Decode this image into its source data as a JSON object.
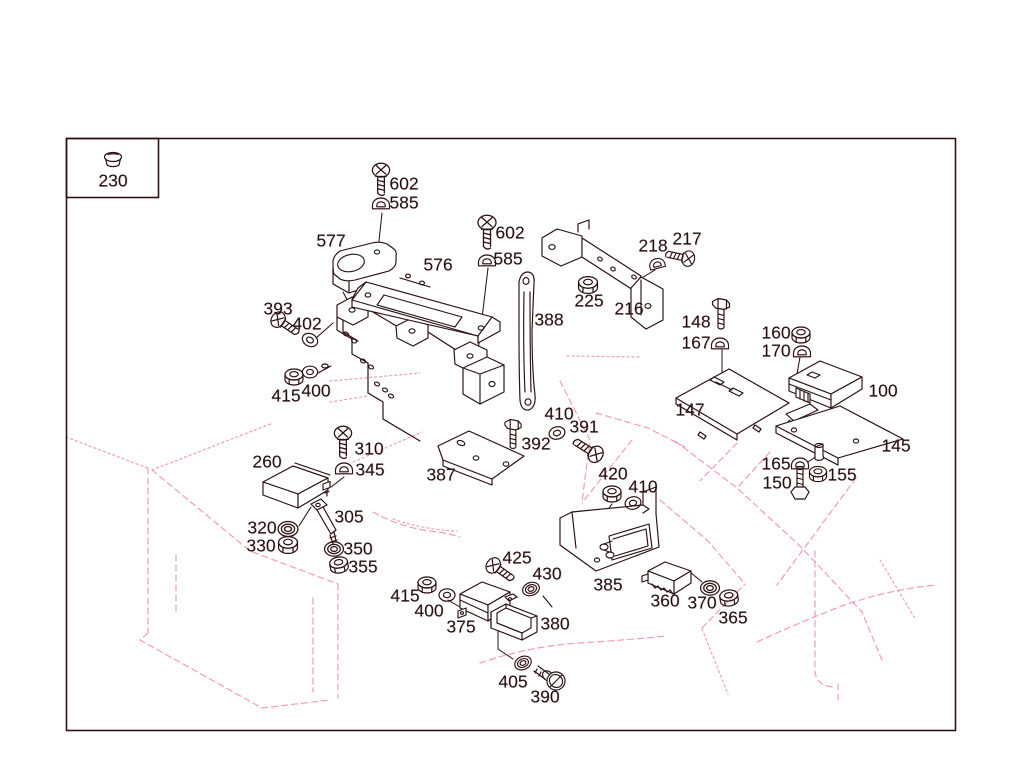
{
  "document": {
    "type": "exploded-parts-diagram",
    "legend_box": {
      "part": "230",
      "icon": "cap-fastener"
    }
  },
  "diagram": {
    "colors": {
      "ink": "#2a1213",
      "body": "#f09fb0",
      "text": "#1b1111",
      "paper": "#ffffff"
    },
    "labels": [
      {
        "part": "230",
        "x": 113,
        "y": 181
      },
      {
        "part": "602",
        "x": 404,
        "y": 184
      },
      {
        "part": "585",
        "x": 404,
        "y": 203
      },
      {
        "part": "577",
        "x": 331,
        "y": 241
      },
      {
        "part": "576",
        "x": 438,
        "y": 265
      },
      {
        "part": "602",
        "n": 2,
        "x": 510,
        "y": 233
      },
      {
        "part": "585",
        "n": 2,
        "x": 508,
        "y": 259
      },
      {
        "part": "218",
        "x": 653,
        "y": 246
      },
      {
        "part": "217",
        "x": 687,
        "y": 239
      },
      {
        "part": "225",
        "x": 589,
        "y": 301
      },
      {
        "part": "216",
        "x": 629,
        "y": 309
      },
      {
        "part": "388",
        "x": 549,
        "y": 320
      },
      {
        "part": "393",
        "x": 278,
        "y": 309
      },
      {
        "part": "402",
        "x": 307,
        "y": 324
      },
      {
        "part": "148",
        "x": 696,
        "y": 322
      },
      {
        "part": "167",
        "x": 696,
        "y": 343
      },
      {
        "part": "160",
        "x": 776,
        "y": 333
      },
      {
        "part": "170",
        "x": 776,
        "y": 351
      },
      {
        "part": "100",
        "x": 883,
        "y": 391
      },
      {
        "part": "147",
        "x": 690,
        "y": 410
      },
      {
        "part": "145",
        "x": 896,
        "y": 446
      },
      {
        "part": "415",
        "x": 286,
        "y": 396
      },
      {
        "part": "400",
        "x": 316,
        "y": 391
      },
      {
        "part": "410",
        "x": 559,
        "y": 414
      },
      {
        "part": "391",
        "x": 584,
        "y": 427
      },
      {
        "part": "392",
        "x": 536,
        "y": 444
      },
      {
        "part": "310",
        "x": 369,
        "y": 449
      },
      {
        "part": "345",
        "x": 370,
        "y": 470
      },
      {
        "part": "260",
        "x": 267,
        "y": 462
      },
      {
        "part": "387",
        "x": 441,
        "y": 475
      },
      {
        "part": "420",
        "x": 613,
        "y": 474
      },
      {
        "part": "410",
        "n": 2,
        "x": 643,
        "y": 487
      },
      {
        "part": "305",
        "x": 349,
        "y": 517
      },
      {
        "part": "320",
        "x": 262,
        "y": 528
      },
      {
        "part": "330",
        "x": 261,
        "y": 546
      },
      {
        "part": "350",
        "x": 358,
        "y": 549
      },
      {
        "part": "355",
        "x": 363,
        "y": 567
      },
      {
        "part": "165",
        "x": 776,
        "y": 464
      },
      {
        "part": "150",
        "x": 777,
        "y": 483
      },
      {
        "part": "155",
        "x": 842,
        "y": 475
      },
      {
        "part": "425",
        "x": 517,
        "y": 558
      },
      {
        "part": "430",
        "x": 547,
        "y": 574
      },
      {
        "part": "385",
        "x": 608,
        "y": 585
      },
      {
        "part": "415",
        "n": 2,
        "x": 405,
        "y": 596
      },
      {
        "part": "400",
        "n": 2,
        "x": 429,
        "y": 611
      },
      {
        "part": "375",
        "x": 461,
        "y": 627
      },
      {
        "part": "380",
        "x": 555,
        "y": 624
      },
      {
        "part": "360",
        "x": 665,
        "y": 601
      },
      {
        "part": "370",
        "x": 702,
        "y": 603
      },
      {
        "part": "365",
        "x": 733,
        "y": 618
      },
      {
        "part": "405",
        "x": 513,
        "y": 682
      },
      {
        "part": "390",
        "x": 545,
        "y": 697
      }
    ]
  }
}
